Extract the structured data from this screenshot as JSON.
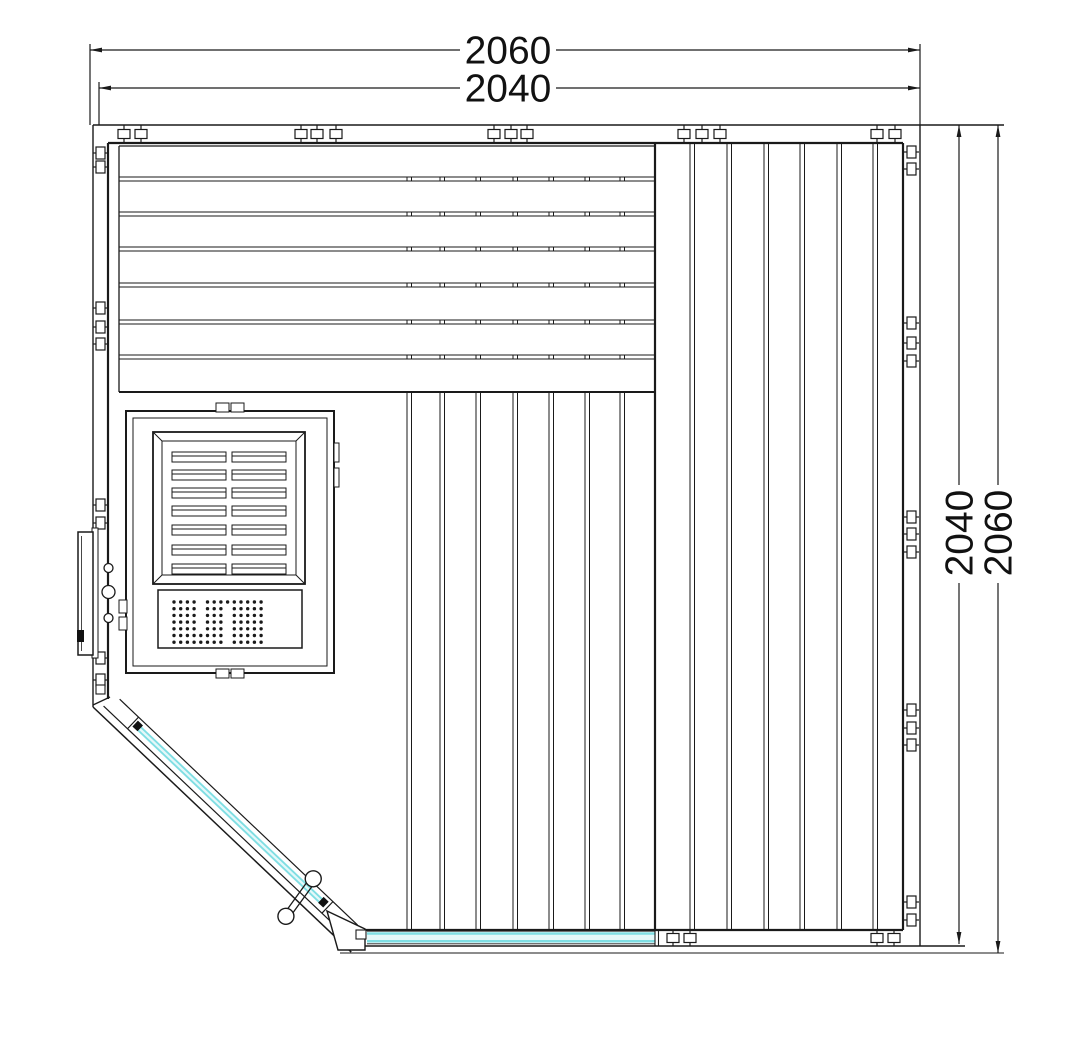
{
  "drawing": {
    "kind": "corner sauna floor plan",
    "dimensions": {
      "top": [
        {
          "value": "2060"
        },
        {
          "value": "2040"
        }
      ],
      "right": [
        {
          "value": "2040"
        },
        {
          "value": "2060"
        }
      ]
    }
  },
  "colors": {
    "line": "#1a1a1a",
    "glass_fill": "#e4f8f9",
    "glass_edge": "#7edee3",
    "text": "#111111"
  }
}
